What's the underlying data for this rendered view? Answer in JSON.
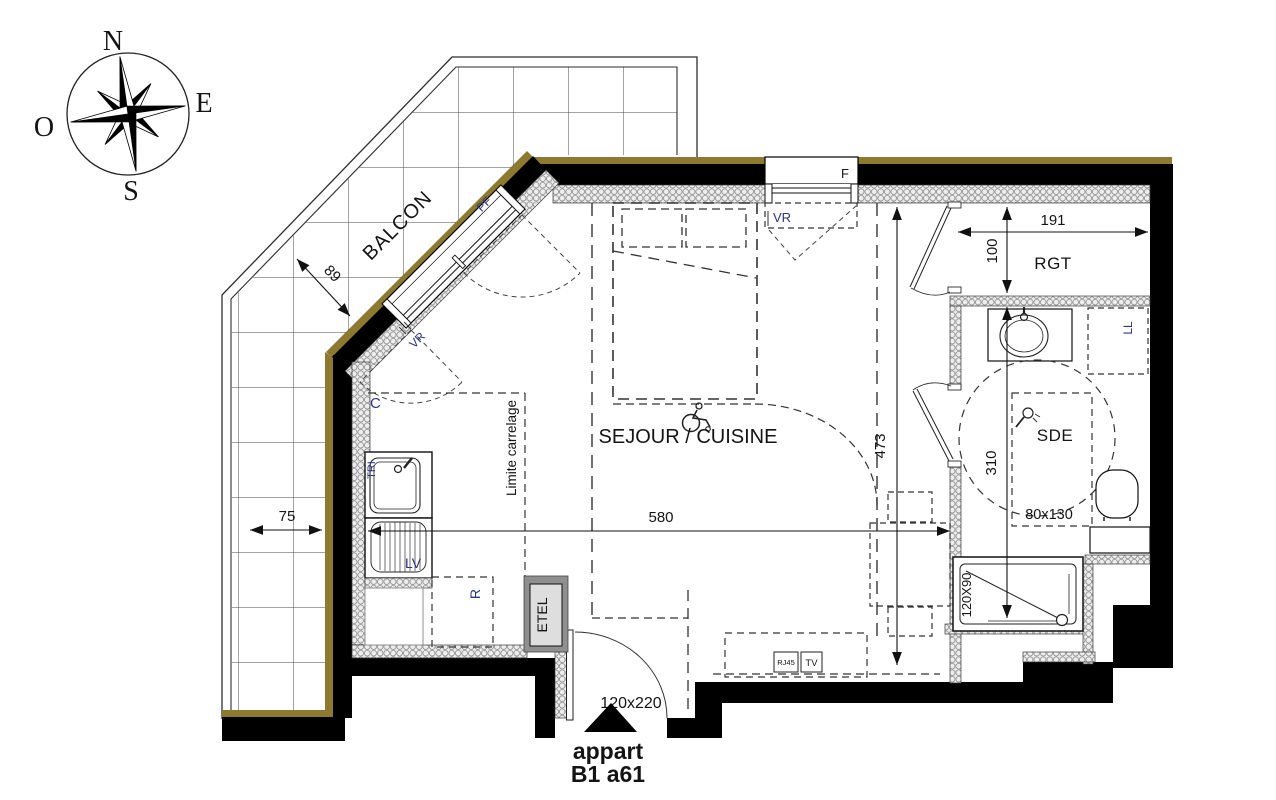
{
  "title": "Plan appartement B1 a61",
  "compass": {
    "n": "N",
    "e": "E",
    "s": "S",
    "o": "O"
  },
  "rooms": {
    "balcony": "BALCON",
    "living": "SEJOUR / CUISINE",
    "storage": "RGT",
    "bathroom": "SDE"
  },
  "apartment": {
    "line1": "appart",
    "line2": "B1 a61"
  },
  "dimensions": {
    "balcony_depth": "89",
    "balcony_strip": "75",
    "rgt_width": "191",
    "rgt_depth": "100",
    "living_length": "473",
    "living_width": "580",
    "sde_depth": "310",
    "shower": "120X90",
    "transfer_zone": "80x130",
    "door": "120x220"
  },
  "labels": {
    "window": "F",
    "shutter1": "VR",
    "shutter2": "VR",
    "french_window": "PF",
    "closet": "C",
    "tile_limit": "Limite carrelage",
    "sorting": "TRI",
    "dishwasher": "LV",
    "fridge": "R",
    "elec_panel": "ETEL",
    "washer": "LL",
    "rj45": "RJ45",
    "tv": "TV"
  },
  "colors": {
    "wall": "#000000",
    "facade_stripe": "#8d7a30",
    "insulation_fill": "#ededed",
    "insulation_stroke": "#8f8f8f",
    "text": "#141414",
    "label_blue": "#2b3580"
  }
}
